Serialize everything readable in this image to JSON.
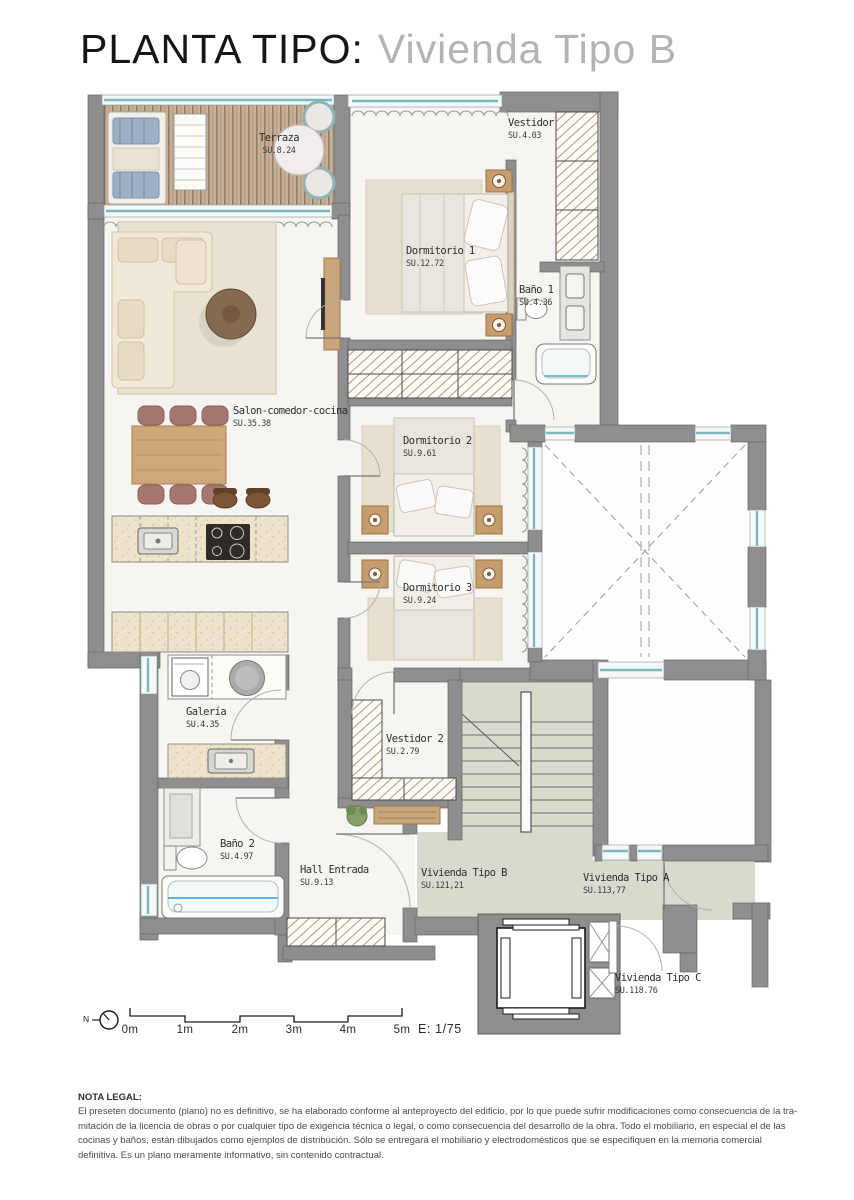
{
  "title": {
    "main": "PLANTA TIPO:",
    "sub": "Vivienda Tipo B"
  },
  "rooms": [
    {
      "id": "terraza",
      "name": "Terraza",
      "area": "SU.8.24"
    },
    {
      "id": "vestidor",
      "name": "Vestidor",
      "area": "SU.4.03"
    },
    {
      "id": "dormitorio1",
      "name": "Dormitorio 1",
      "area": "SU.12.72"
    },
    {
      "id": "bano1",
      "name": "Baño 1",
      "area": "SU.4.36"
    },
    {
      "id": "salon",
      "name": "Salon-comedor-cocina",
      "area": "SU.35.38"
    },
    {
      "id": "dormitorio2",
      "name": "Dormitorio 2",
      "area": "SU.9.61"
    },
    {
      "id": "dormitorio3",
      "name": "Dormitorio 3",
      "area": "SU.9.24"
    },
    {
      "id": "galeria",
      "name": "Galería",
      "area": "SU.4.35"
    },
    {
      "id": "vestidor2",
      "name": "Vestidor 2",
      "area": "SU.2.79"
    },
    {
      "id": "bano2",
      "name": "Baño 2",
      "area": "SU.4.97"
    },
    {
      "id": "hall",
      "name": "Hall Entrada",
      "area": "SU.9.13"
    },
    {
      "id": "viviendaB",
      "name": "Vivienda Tipo B",
      "area": "SU.121,21"
    },
    {
      "id": "viviendaA",
      "name": "Vivienda Tipo A",
      "area": "SU.113,77"
    },
    {
      "id": "viviendaC",
      "name": "Vivienda Tipo C",
      "area": "SU.118.76"
    }
  ],
  "scale_bar": {
    "ticks": [
      "0m",
      "1m",
      "2m",
      "3m",
      "4m",
      "5m"
    ],
    "ratio": "E: 1/75"
  },
  "compass": {
    "label": "N"
  },
  "legal": {
    "heading": "NOTA LEGAL:",
    "body": "El preseten documento (plano) no es definitivo, se ha elaborado conforme al anteproyecto del edificio, por lo que puede sufrir modificaciones como consecuencia de la tra-mitación de la licencia de obras o por cualquier tipo de exigencia técnica o legal, o como consecuencia del desarrollo de la obra. Todo el mobiliario, en especial el de las cocinas y baños, están dibujados como ejemplos de distribución. Sólo se entregará el mobiliario y electrodomésticos que se especifiquen en la memoria comercial definitiva. Es un plano meramente informativo, sin contenido contractual."
  },
  "palette": {
    "wall": "#8e8e8e",
    "deck_wood": "#c7b098",
    "glazing_blue": "#7fb8bc",
    "landing_green": "#d7dbce",
    "rug": "#e8e1d0",
    "wood_furniture": "#c9a57a",
    "chair_mauve": "#a6776f",
    "counter_cream": "#ece3cb",
    "label_text": "#2e2e2e",
    "title_sub": "#b3b3b6"
  }
}
